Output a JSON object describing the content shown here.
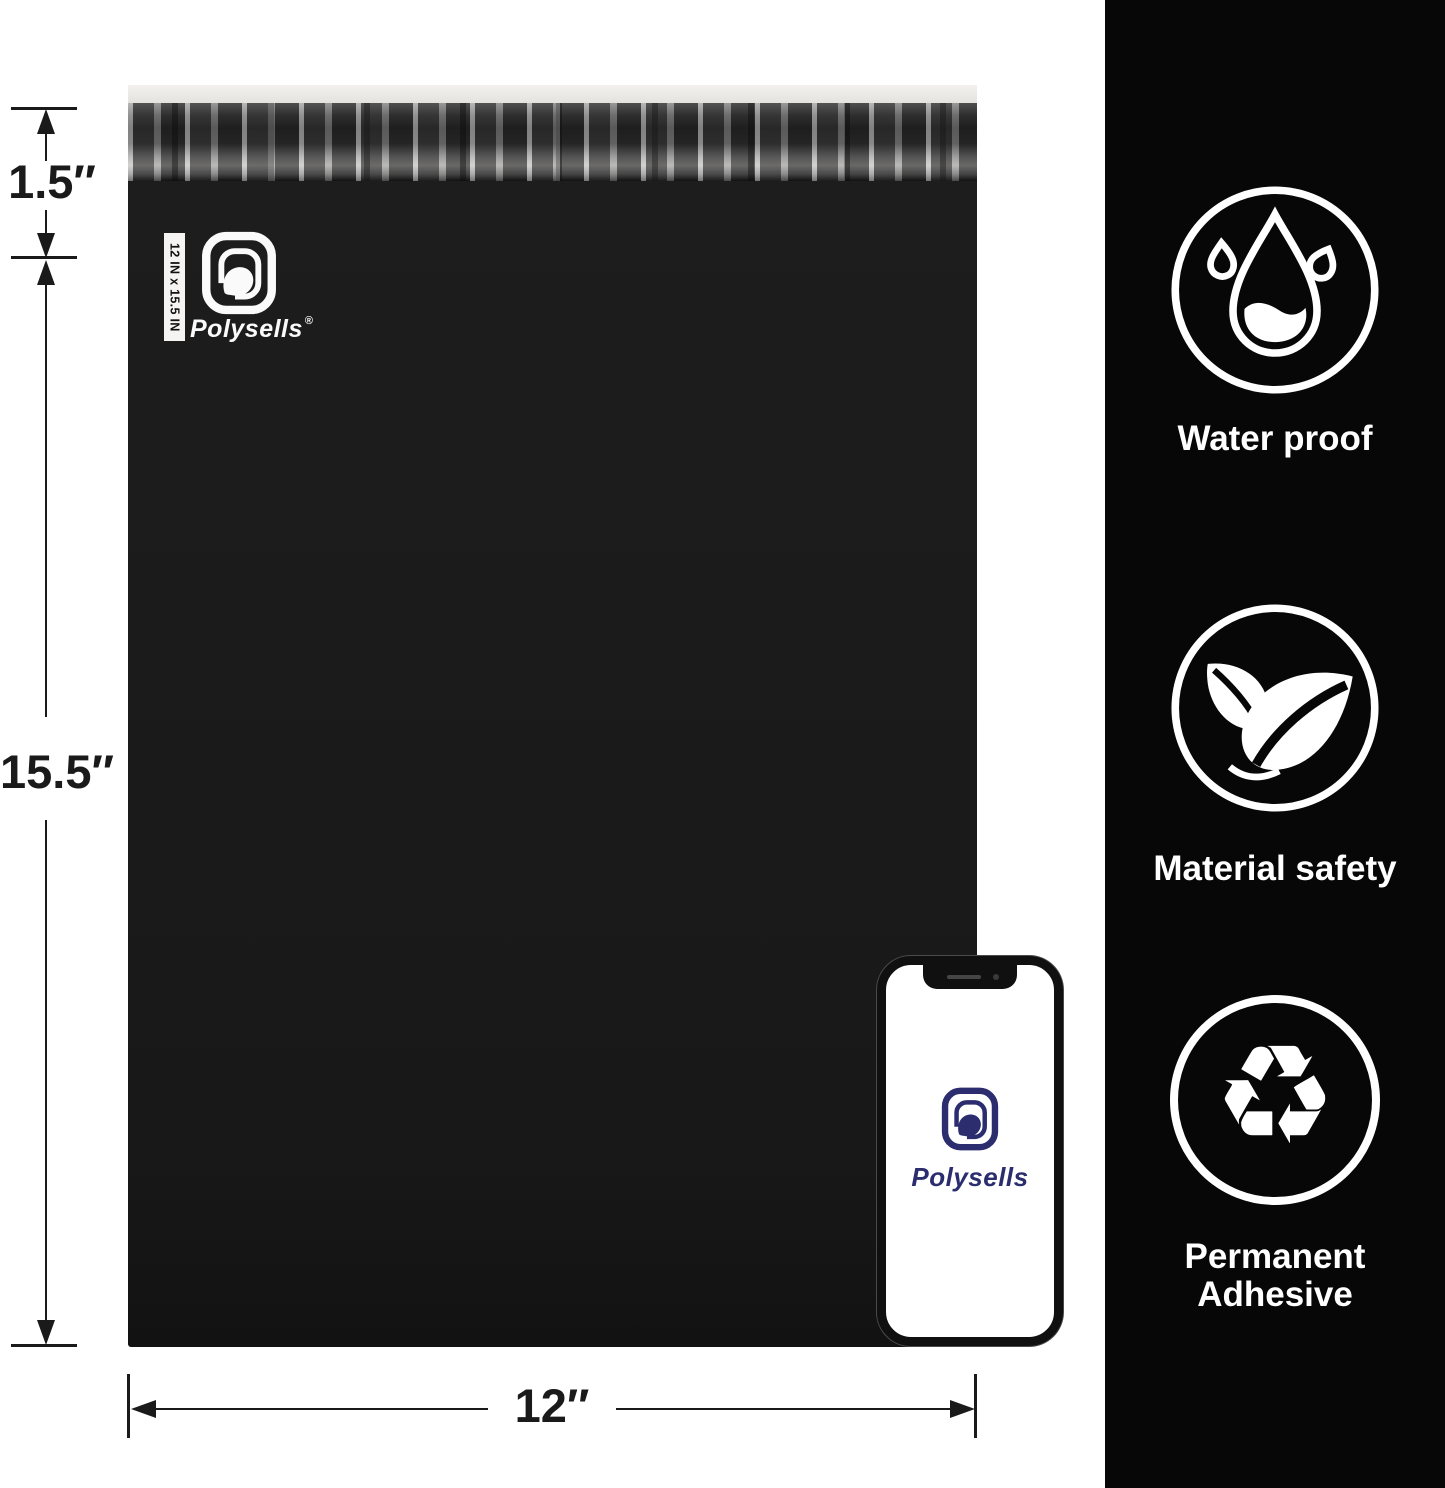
{
  "bag": {
    "brand": "Polysells",
    "registered": "®",
    "size_strip": "12 IN x 15.5 IN"
  },
  "phone": {
    "brand": "Polysells"
  },
  "dimensions": {
    "flap": "1.5″",
    "height": "15.5″",
    "width": "12″"
  },
  "features": [
    {
      "icon": "water-drop-icon",
      "label": "Water proof"
    },
    {
      "icon": "leaves-icon",
      "label": "Material safety"
    },
    {
      "icon": "recycle-icon",
      "label": "Permanent Adhesive",
      "glyph": "♻"
    }
  ],
  "colors": {
    "panel": "#070707",
    "bag": "#1b1b1b",
    "navy": "#2b2d6f",
    "dimension_ink": "#1a1a1a"
  }
}
